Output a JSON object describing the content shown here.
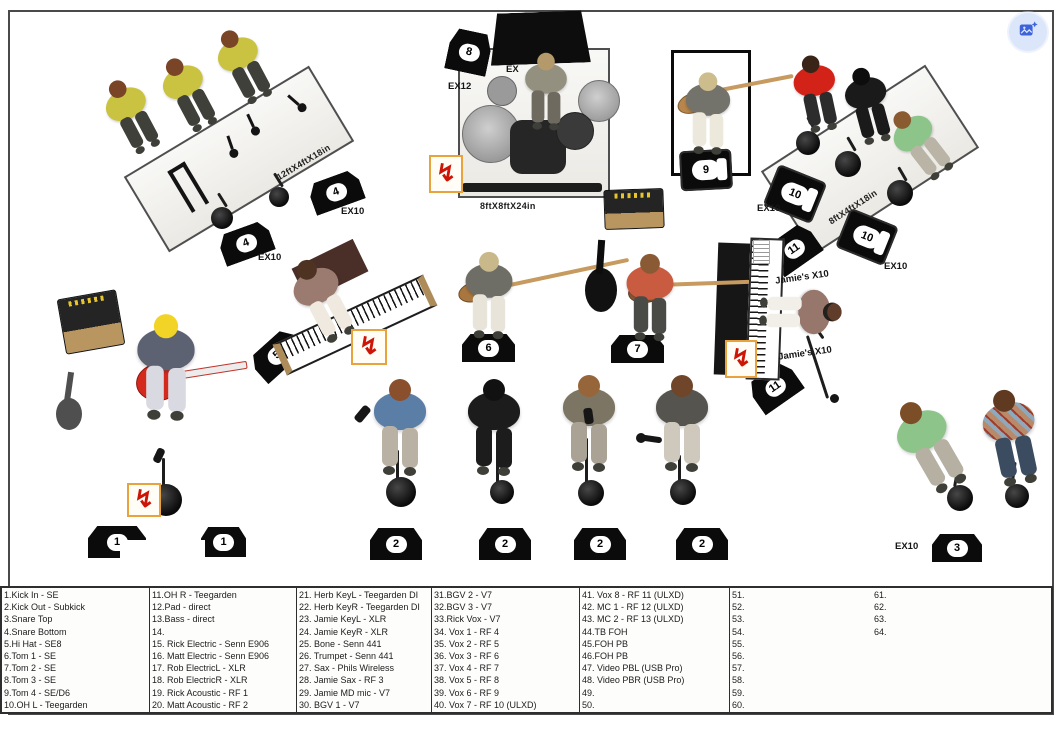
{
  "colors": {
    "edit_button_bg": "#dbe6fa",
    "edit_button_icon": "#3d63d9",
    "monitor_black": "#0b0b0b",
    "power_red": "#cc1507",
    "power_box_border": "#e8a33d"
  },
  "stage": {
    "riser_labels": {
      "horn_riser": "12ftX4ftX18in",
      "drum_riser": "8ftX8ftX24in",
      "bgv_riser": "8ftX4ftX18in"
    },
    "equipment_labels": {
      "ex10": "EX10",
      "ex12": "EX12",
      "ex_partial": "EX",
      "jamies_x10": "Jamie's X10"
    },
    "monitor_numbers": {
      "m1": "1",
      "m2": "2",
      "m3": "3",
      "m4": "4",
      "m5": "5",
      "m6": "6",
      "m7": "7",
      "m8": "8",
      "m9": "9",
      "m10": "10",
      "m11": "11"
    },
    "power_symbol": "↯"
  },
  "input_list": {
    "columns": [
      {
        "rows": [
          "1.Kick In - SE",
          "2.Kick Out - Subkick",
          "3.Snare Top",
          "4.Snare Bottom",
          "5.Hi Hat - SE8",
          "6.Tom 1 - SE",
          "7.Tom 2 - SE",
          "8.Tom 3 - SE",
          "9.Tom 4 - SE/D6",
          "10.OH L - Teegarden"
        ]
      },
      {
        "rows": [
          "11.OH R - Teegarden",
          "12.Pad - direct",
          "13.Bass - direct",
          "14.",
          "15. Rick Electric - Senn E906",
          "16. Matt Electric - Senn E906",
          "17. Rob ElectricL - XLR",
          "18. Rob ElectricR - XLR",
          "19. Rick Acoustic - RF 1",
          "20. Matt Acoustic - RF 2"
        ]
      },
      {
        "rows": [
          "21. Herb KeyL - Teegarden DI",
          "22. Herb KeyR - Teegarden DI",
          "23. Jamie KeyL - XLR",
          "24. Jamie KeyR - XLR",
          "25. Bone - Senn 441",
          "26. Trumpet - Senn 441",
          "27. Sax - Phils Wireless",
          "28. Jamie Sax - RF 3",
          "29. Jamie MD mic - V7",
          "30. BGV 1 - V7"
        ]
      },
      {
        "rows": [
          "31.BGV 2 - V7",
          "32.BGV 3 - V7",
          "33.Rick Vox - V7",
          "34. Vox 1 - RF 4",
          "35. Vox 2 - RF 5",
          "36. Vox 3 - RF 6",
          "37. Vox 4 - RF 7",
          "38. Vox 5 - RF 8",
          "39. Vox 6 - RF 9",
          "40. Vox 7 - RF 10 (ULXD)"
        ]
      },
      {
        "rows": [
          "41. Vox 8 - RF 11 (ULXD)",
          "42. MC 1 - RF 12 (ULXD)",
          "43. MC 2 - RF 13 (ULXD)",
          "44.TB FOH",
          "45.FOH PB",
          "46.FOH PB",
          "47. Video PBL (USB Pro)",
          "48. Video PBR (USB Pro)",
          "49.",
          "50."
        ]
      },
      {
        "rows": [
          "51.",
          "52.",
          "53.",
          "54.",
          "55.",
          "56.",
          "57.",
          "58.",
          "59.",
          "60."
        ]
      },
      {
        "rows": [
          "61.",
          "62.",
          "63.",
          "64."
        ]
      }
    ]
  }
}
